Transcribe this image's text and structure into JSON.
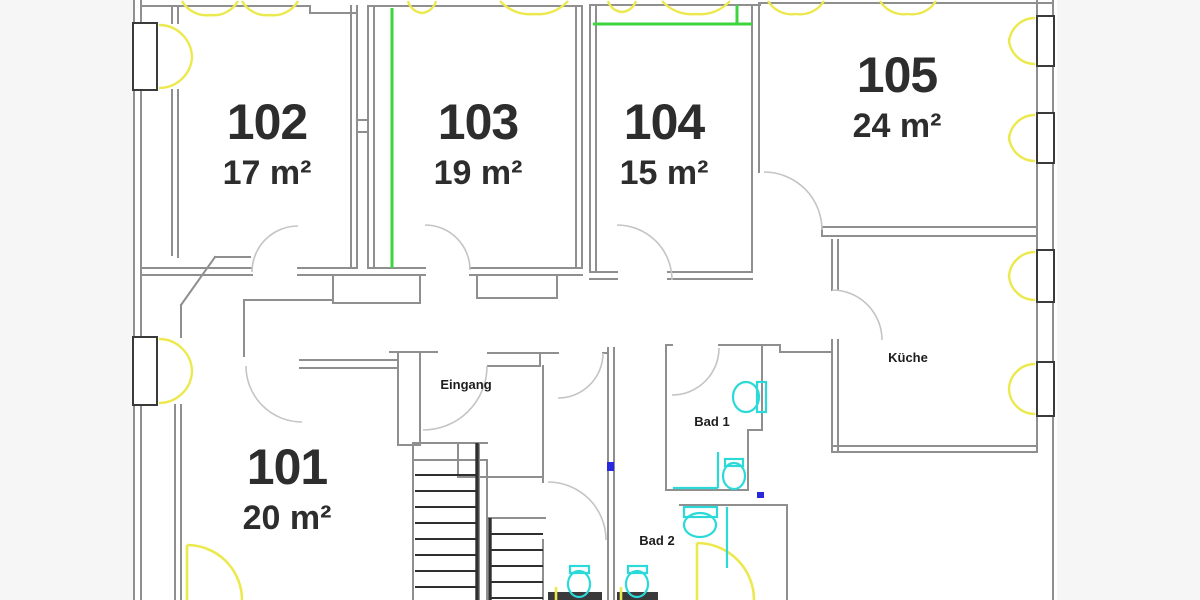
{
  "plan": {
    "rooms": [
      {
        "number": "101",
        "area": "20 m²"
      },
      {
        "number": "102",
        "area": "17 m²"
      },
      {
        "number": "103",
        "area": "19 m²"
      },
      {
        "number": "104",
        "area": "15 m²"
      },
      {
        "number": "105",
        "area": "24 m²"
      }
    ],
    "labels": {
      "kitchen": "Küche",
      "bath_1": "Bad 1",
      "bath_2": "Bad 2",
      "entrance": "Eingang"
    },
    "colors": {
      "wall": "#8f8f8f",
      "dark": "#3a3a3a",
      "tread": "#2f2f2f",
      "green": "#3ed43e",
      "yellow": "#ece94f",
      "cyan": "#2bd9d9",
      "blue": "#2828dc",
      "door": "#c4c4c4",
      "text": "#2d2d2d",
      "paper": "#ffffff",
      "margin": "#f6f6f6"
    }
  }
}
